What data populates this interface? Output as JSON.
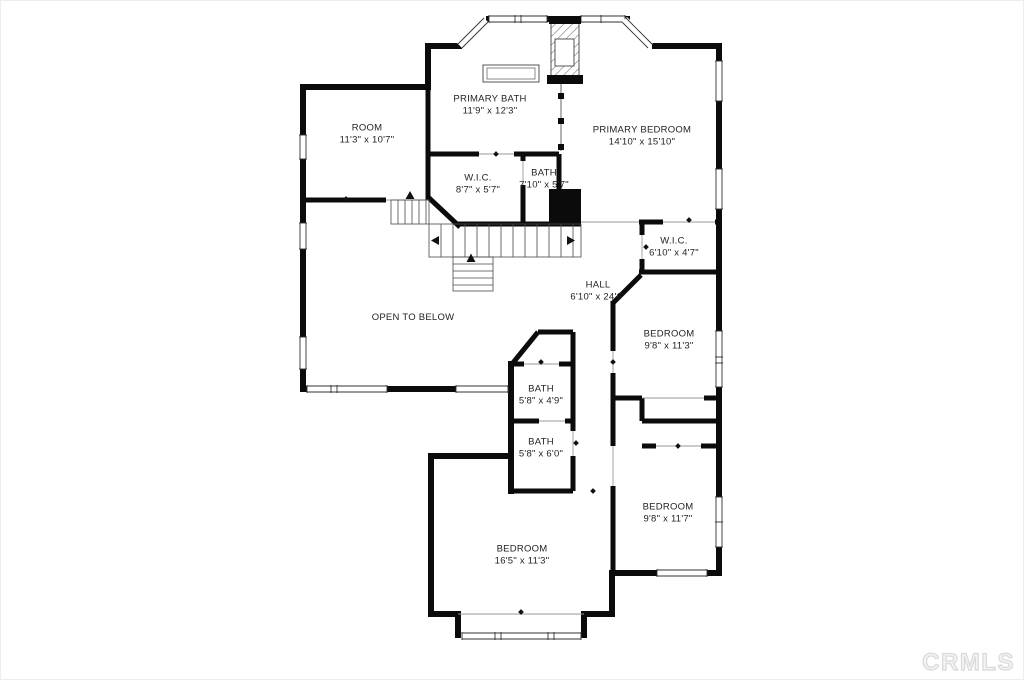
{
  "rooms": [
    {
      "name": "PRIMARY BATH",
      "dims": "11'9\" x 12'3\""
    },
    {
      "name": "ROOM",
      "dims": "11'3\" x 10'7\""
    },
    {
      "name": "W.I.C.",
      "dims": "8'7\" x 5'7\""
    },
    {
      "name": "BATH",
      "dims": "7'10\" x 5'7\""
    },
    {
      "name": "PRIMARY BEDROOM",
      "dims": "14'10\" x 15'10\""
    },
    {
      "name": "W.I.C.",
      "dims": "6'10\" x 4'7\""
    },
    {
      "name": "HALL",
      "dims": "6'10\" x 24'6\""
    },
    {
      "name": "BEDROOM",
      "dims": "9'8\" x 11'3\""
    },
    {
      "name": "OPEN TO BELOW",
      "dims": ""
    },
    {
      "name": "BATH",
      "dims": "5'8\" x 4'9\""
    },
    {
      "name": "BATH",
      "dims": "5'8\" x 6'0\""
    },
    {
      "name": "BEDROOM",
      "dims": "9'8\" x 11'7\""
    },
    {
      "name": "BEDROOM",
      "dims": "16'5\" x 11'3\""
    }
  ],
  "watermark": {
    "text": "CRMLS"
  },
  "colors": {
    "wall": "#0b0b0b",
    "background": "#ffffff",
    "watermark_stroke": "#d9d9d9",
    "thin_line": "#3a3a3a"
  }
}
